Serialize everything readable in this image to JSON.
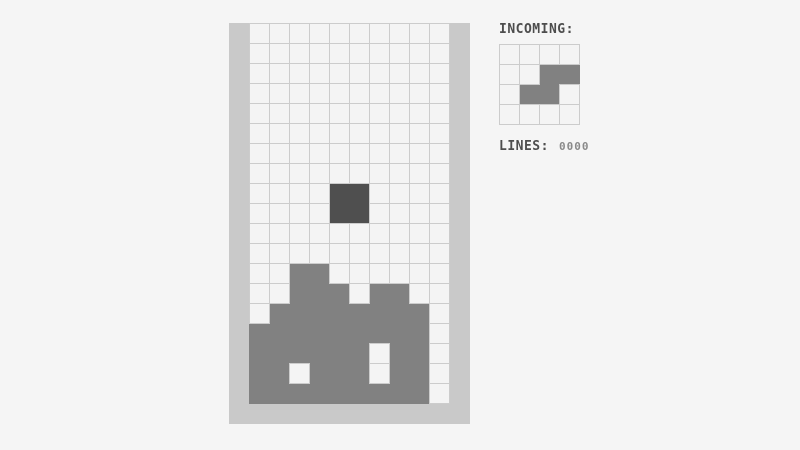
{
  "colors": {
    "page_bg": "#f5f5f5",
    "wall": "#c9c9c9",
    "cell_empty": "#f4f4f4",
    "grid_line": "#cccccc",
    "stack": "#818181",
    "label_text": "#4d4d4d",
    "value_text": "#8a8a8a"
  },
  "board": {
    "cols": 10,
    "rows": 19,
    "cell_px": 20,
    "stack_rows": [
      "..........",
      "..........",
      "..........",
      "..........",
      "..........",
      "..........",
      "..........",
      "..........",
      "..........",
      "..........",
      "..........",
      "..........",
      "..XX......",
      "..XXX.XX..",
      ".XXXXXXXX.",
      "XXXXXXXXX.",
      "XXXXXX.XX.",
      "XX.XXX.XX.",
      "XXXXXXXXX."
    ],
    "falling_piece": {
      "row": 8,
      "col": 4,
      "cells": [
        "XX",
        "XX"
      ],
      "color": "#4f4f4f"
    }
  },
  "side_panel": {
    "incoming_label": "INCOMING:",
    "preview": {
      "cols": 4,
      "rows": 4,
      "cell_px": 20,
      "piece_rows": [
        "....",
        "..XX",
        ".XX.",
        "...."
      ],
      "piece_color": "#818181"
    },
    "lines_label": "LINES:",
    "lines_value": "0000"
  }
}
